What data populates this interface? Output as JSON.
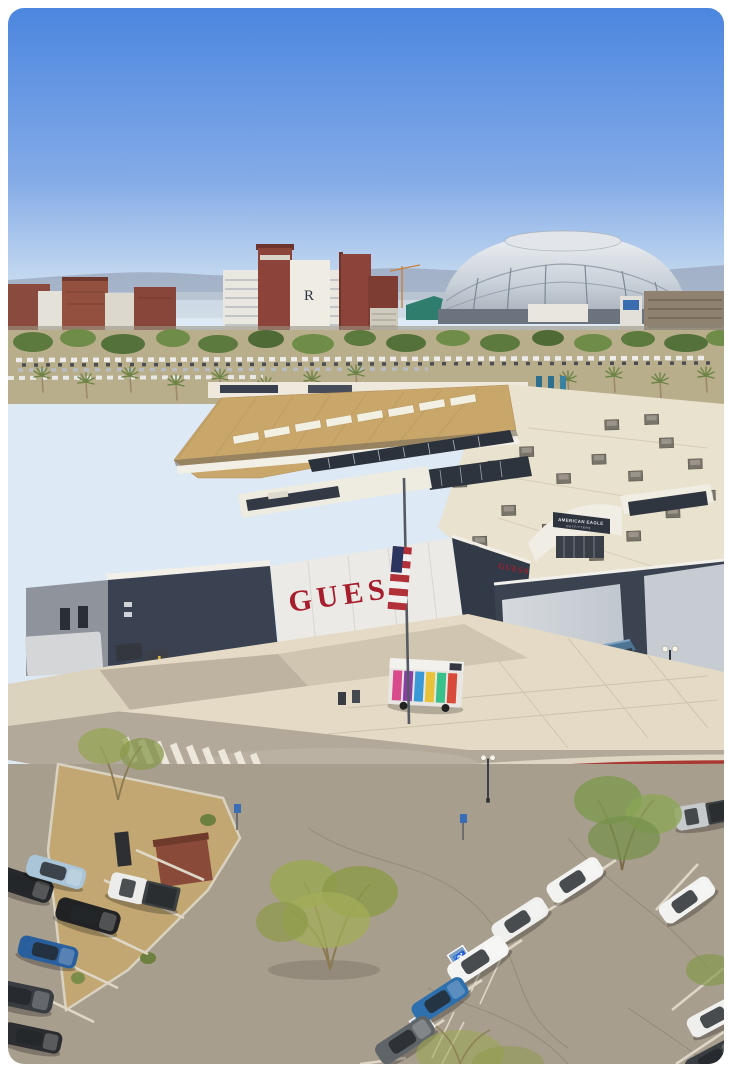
{
  "photo": {
    "description": "Aerial drone view of an outlet shopping center with GUESS and American Eagle storefronts, plazas, roads and parking lots with cars and desert trees; a silver domed stadium, brick hotel with R monogram and mountains sit on the horizon under a clear blue sky",
    "signs": {
      "guess_main": "GUESS",
      "guess_side": "GUESS",
      "american_eagle_line1": "AMERICAN EAGLE",
      "american_eagle_line2": "OUTFITTERS",
      "hotel_monogram": "R",
      "handicap_symbol": "♿"
    },
    "colors": {
      "sky_top": "#4c86df",
      "sky_horizon": "#dde9f4",
      "guess_red": "#a61e2c",
      "roof_tan": "#c9a66a",
      "flat_roof": "#e9e2cf",
      "dark_wall": "#3a4150",
      "light_wall": "#eceae6",
      "plaza": "#e4dac5",
      "asphalt": "#a89e8e",
      "red_curb": "#a83a33",
      "dirt": "#c2a772",
      "tree_green": "#9aa851",
      "card_background": "#ffffff"
    }
  }
}
